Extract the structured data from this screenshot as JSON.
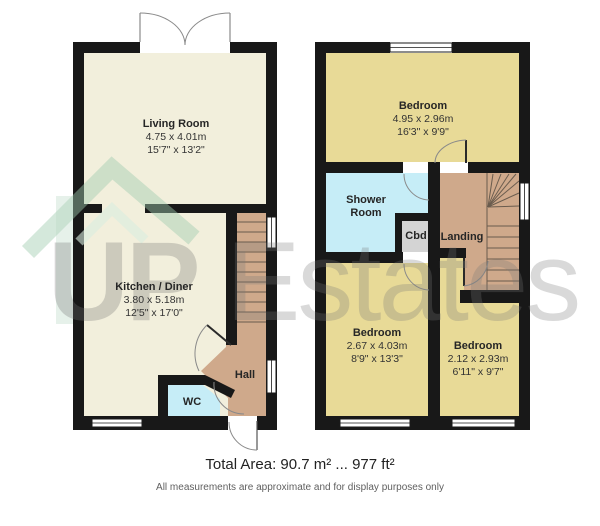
{
  "watermark": {
    "brand_up": "UP",
    "brand_estates": "Estates"
  },
  "footer": {
    "total_area": "Total Area: 90.7 m² ... 977 ft²",
    "disclaimer": "All measurements are approximate and for display purposes only"
  },
  "ground_floor": {
    "living_room": {
      "name": "Living Room",
      "metric": "4.75 x 4.01m",
      "imperial": "15'7\" x 13'2\""
    },
    "kitchen_diner": {
      "name": "Kitchen / Diner",
      "metric": "3.80 x 5.18m",
      "imperial": "12'5\" x 17'0\""
    },
    "hall": {
      "name": "Hall"
    },
    "wc": {
      "name": "WC"
    }
  },
  "first_floor": {
    "bedroom_1": {
      "name": "Bedroom",
      "metric": "4.95 x 2.96m",
      "imperial": "16'3\" x 9'9\""
    },
    "shower_room": {
      "name": "Shower Room"
    },
    "cupboard": {
      "name": "Cbd"
    },
    "landing": {
      "name": "Landing"
    },
    "bedroom_2": {
      "name": "Bedroom",
      "metric": "2.67 x 4.03m",
      "imperial": "8'9\" x 13'3\""
    },
    "bedroom_3": {
      "name": "Bedroom",
      "metric": "2.12 x 2.93m",
      "imperial": "6'11\" x 9'7\""
    }
  },
  "colors": {
    "wall": "#181818",
    "room_cream": "#f2efdc",
    "room_khaki": "#e8da97",
    "room_blue": "#c6edf7",
    "room_tan": "#cfa98b",
    "room_gray": "#d4d4d4",
    "watermark_green": "#9fcdb0"
  }
}
